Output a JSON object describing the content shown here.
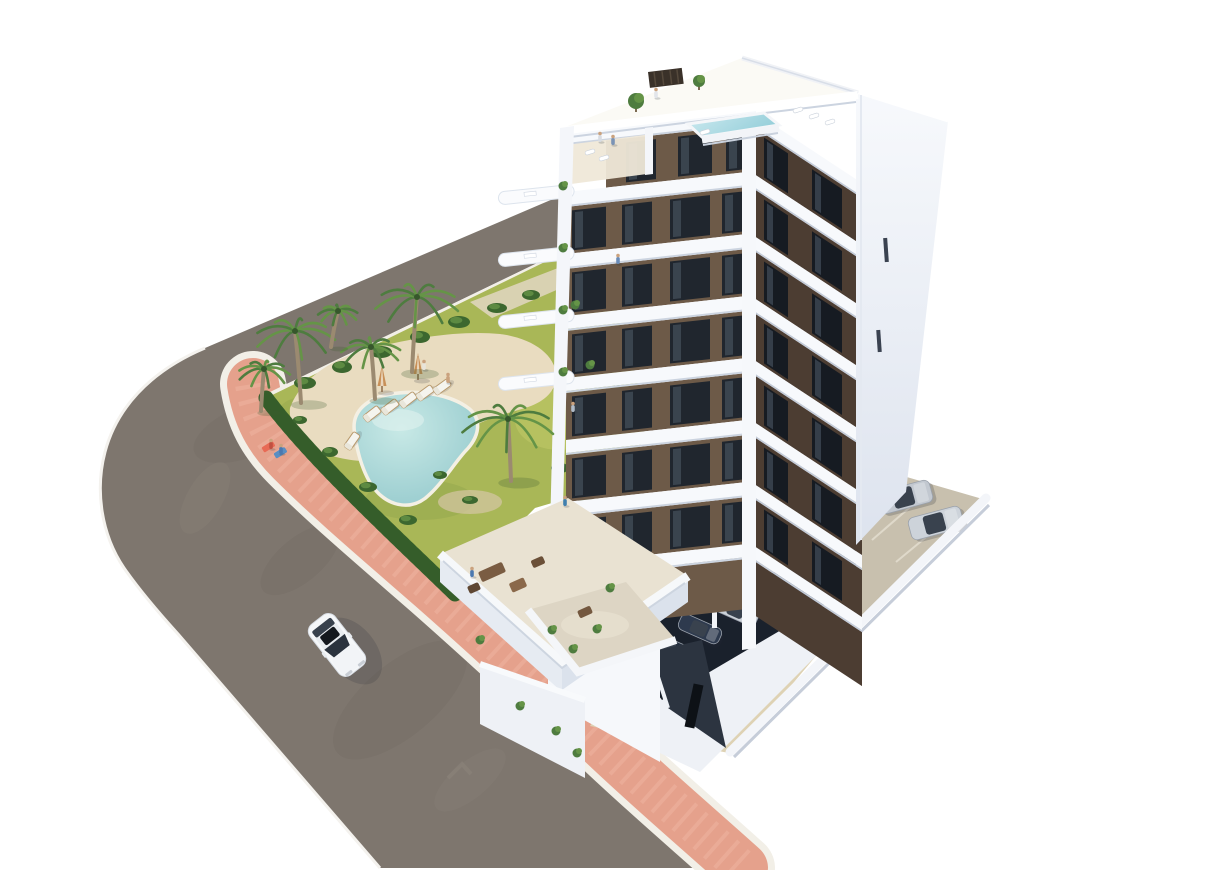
{
  "scene": {
    "type": "architectural-3d-render",
    "subject": "aerial view of a modern white apartment block with brown glazed facade panels, rooftop plunge pool, landscaped garden with free-form swimming pool, palm trees, curved road with salmon sidewalk, a driving white car and residents parking",
    "objects": {
      "building": {
        "floors": 8,
        "rooftop_pool": 1,
        "balconies": "curved white bands",
        "facade": "white with dark brown window panels"
      },
      "garden_pool": 1,
      "rooftop_pool": 1,
      "palm_trees": 6,
      "sun_loungers": 6,
      "parasols": 2,
      "driving_cars": 1,
      "parked_cars_lot": 2,
      "parked_cars_covered": 5,
      "people_visible": 11
    },
    "palms": [
      {
        "x": 295,
        "y": 331,
        "r": 40,
        "t": 72,
        "lean": -6
      },
      {
        "x": 417,
        "y": 297,
        "r": 42,
        "t": 75,
        "lean": 5
      },
      {
        "x": 371,
        "y": 347,
        "r": 30,
        "t": 52,
        "lean": -4
      },
      {
        "x": 264,
        "y": 369,
        "r": 26,
        "t": 42,
        "lean": 3
      },
      {
        "x": 508,
        "y": 419,
        "r": 46,
        "t": 62,
        "lean": -3
      },
      {
        "x": 338,
        "y": 311,
        "r": 20,
        "t": 36,
        "lean": 7
      }
    ],
    "loungers": [
      {
        "x": 372,
        "y": 414,
        "rot": -38
      },
      {
        "x": 390,
        "y": 407,
        "rot": -38
      },
      {
        "x": 408,
        "y": 400,
        "rot": -38
      },
      {
        "x": 425,
        "y": 393,
        "rot": -36
      },
      {
        "x": 442,
        "y": 387,
        "rot": -36
      },
      {
        "x": 352,
        "y": 441,
        "rot": -55
      }
    ],
    "parasols": [
      {
        "x": 382,
        "y": 392
      },
      {
        "x": 418,
        "y": 380
      }
    ],
    "bushes": [
      {
        "x": 305,
        "y": 383,
        "rx": 11,
        "ry": 6
      },
      {
        "x": 342,
        "y": 367,
        "rx": 10,
        "ry": 6
      },
      {
        "x": 381,
        "y": 352,
        "rx": 11,
        "ry": 6
      },
      {
        "x": 420,
        "y": 337,
        "rx": 10,
        "ry": 6
      },
      {
        "x": 459,
        "y": 322,
        "rx": 11,
        "ry": 6
      },
      {
        "x": 497,
        "y": 308,
        "rx": 10,
        "ry": 5
      },
      {
        "x": 531,
        "y": 295,
        "rx": 9,
        "ry": 5
      },
      {
        "x": 330,
        "y": 452,
        "rx": 8,
        "ry": 5
      },
      {
        "x": 368,
        "y": 487,
        "rx": 9,
        "ry": 5
      },
      {
        "x": 408,
        "y": 520,
        "rx": 9,
        "ry": 5
      },
      {
        "x": 300,
        "y": 420,
        "rx": 7,
        "ry": 4
      },
      {
        "x": 560,
        "y": 468,
        "rx": 9,
        "ry": 5
      },
      {
        "x": 585,
        "y": 498,
        "rx": 8,
        "ry": 5
      },
      {
        "x": 545,
        "y": 528,
        "rx": 8,
        "ry": 5
      },
      {
        "x": 570,
        "y": 320,
        "rx": 8,
        "ry": 5
      },
      {
        "x": 598,
        "y": 352,
        "rx": 8,
        "ry": 5
      },
      {
        "x": 618,
        "y": 390,
        "rx": 8,
        "ry": 5
      },
      {
        "x": 470,
        "y": 500,
        "rx": 8,
        "ry": 4
      },
      {
        "x": 440,
        "y": 475,
        "rx": 7,
        "ry": 4
      }
    ],
    "people": [
      {
        "x": 271,
        "y": 448,
        "c": "#c05040"
      },
      {
        "x": 281,
        "y": 453,
        "c": "#4a78b0"
      },
      {
        "x": 424,
        "y": 369,
        "c": "#e8e4da"
      },
      {
        "x": 448,
        "y": 382,
        "c": "#caa27e"
      },
      {
        "x": 600,
        "y": 141,
        "c": "#d8dce2"
      },
      {
        "x": 613,
        "y": 144,
        "c": "#7a93b5"
      },
      {
        "x": 656,
        "y": 97,
        "c": "#e2e5ea"
      },
      {
        "x": 618,
        "y": 263,
        "c": "#6a8cb8"
      },
      {
        "x": 573,
        "y": 411,
        "c": "#b0bcc9"
      },
      {
        "x": 565,
        "y": 505,
        "c": "#3f7fae"
      },
      {
        "x": 472,
        "y": 576,
        "c": "#4a78b0"
      }
    ],
    "lot_cars": [
      {
        "x": 905,
        "y": 497,
        "rot": -15,
        "w": 54,
        "h": 23,
        "c": "#c2c8d0"
      },
      {
        "x": 936,
        "y": 523,
        "rot": -15,
        "w": 54,
        "h": 23,
        "c": "#cdd3da"
      }
    ],
    "covered_cars": [
      {
        "x": 772,
        "y": 597,
        "rot": 24,
        "w": 44,
        "h": 17,
        "c": "#e2e6ea"
      },
      {
        "x": 737,
        "y": 611,
        "rot": 24,
        "w": 44,
        "h": 17,
        "c": "#ccd2d9"
      },
      {
        "x": 700,
        "y": 629,
        "rot": 24,
        "w": 44,
        "h": 17,
        "c": "#2e3a4e"
      },
      {
        "x": 668,
        "y": 647,
        "rot": 24,
        "w": 44,
        "h": 17,
        "c": "#26303f"
      },
      {
        "x": 643,
        "y": 665,
        "rot": 24,
        "w": 44,
        "h": 17,
        "c": "#1d2634"
      }
    ],
    "plants": [
      {
        "x": 563,
        "y": 186
      },
      {
        "x": 563,
        "y": 248
      },
      {
        "x": 563,
        "y": 310
      },
      {
        "x": 563,
        "y": 372
      },
      {
        "x": 575,
        "y": 305
      },
      {
        "x": 590,
        "y": 365
      },
      {
        "x": 552,
        "y": 630
      },
      {
        "x": 573,
        "y": 649
      },
      {
        "x": 597,
        "y": 629
      },
      {
        "x": 520,
        "y": 706
      },
      {
        "x": 556,
        "y": 731
      },
      {
        "x": 577,
        "y": 753
      },
      {
        "x": 610,
        "y": 588
      },
      {
        "x": 480,
        "y": 640
      }
    ],
    "terrace_furniture": [
      {
        "x": 492,
        "y": 572,
        "w": 26,
        "h": 11,
        "rot": -24,
        "c": "#7a5c42"
      },
      {
        "x": 518,
        "y": 585,
        "w": 16,
        "h": 10,
        "rot": -24,
        "c": "#8a684a"
      },
      {
        "x": 474,
        "y": 588,
        "w": 12,
        "h": 8,
        "rot": -24,
        "c": "#5f4733"
      },
      {
        "x": 538,
        "y": 562,
        "w": 13,
        "h": 8,
        "rot": -24,
        "c": "#6b5038"
      },
      {
        "x": 585,
        "y": 612,
        "w": 14,
        "h": 8,
        "rot": -24,
        "c": "#74583f"
      }
    ],
    "roof_furniture": [
      {
        "x": 798,
        "y": 110
      },
      {
        "x": 814,
        "y": 116
      },
      {
        "x": 830,
        "y": 122
      },
      {
        "x": 590,
        "y": 152
      },
      {
        "x": 604,
        "y": 158
      },
      {
        "x": 705,
        "y": 132
      }
    ]
  },
  "colors": {
    "bg": "#ffffff",
    "asphalt": "#7e766e",
    "asphalt_dark": "#6f675f",
    "asphalt_light": "#8f877e",
    "sidewalk_pink": "#e5a18c",
    "sidewalk_light": "#efb6a2",
    "curb": "#f2efe7",
    "grass": "#a9b757",
    "grass_light": "#c3cb6a",
    "grass_dark": "#8fa34a",
    "hedge": "#3c672f",
    "hedge_dark": "#2f5526",
    "sand": "#e9dcc0",
    "sand_dark": "#d6c6a5",
    "pool_deep": "#8fc6ca",
    "pool_light": "#c8e9e6",
    "pool_rim": "#f4f0e4",
    "palm_green": "#4e7c3f",
    "palm_green2": "#659447",
    "palm_trunk": "#9b8a70",
    "building_white": "#f7f9fc",
    "band_shadow": "#ccd4e0",
    "face_brown": "#6d5a48",
    "face_brown_dark": "#4c3d32",
    "window_dark": "#20262e",
    "window_light": "#515d6a",
    "window_slit": "#161b22",
    "terrace_floor": "#e9e2d2",
    "terrace_wall": "#f4f6f9",
    "wall_shade": "#d6dce6",
    "parking_concrete": "#c8c0ae",
    "apron": "#ded2b4",
    "dark_parking": "#1a212c",
    "ramp_dark": "#2c3440",
    "ramp_black": "#0d1116",
    "car_white": "#f5f7f9",
    "umbrella": "#c89058",
    "umbrella_stripe": "#efe3cf",
    "lounger": "#f5f4ee",
    "lounger_frame": "#b8996c",
    "shadow": "#252b38"
  }
}
